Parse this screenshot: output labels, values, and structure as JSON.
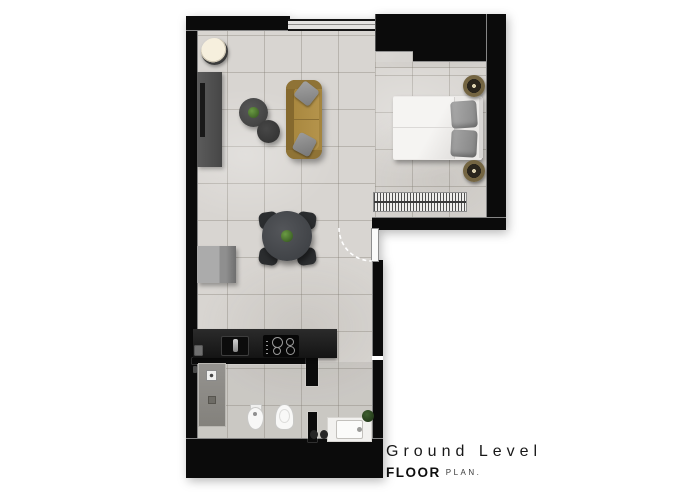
{
  "title": {
    "line1": "Ground Level",
    "line2_bold": "FLOOR",
    "line2_rest": "PLAN."
  },
  "palette": {
    "background": "#ffffff",
    "wall": "#0b0b0b",
    "floor_tile": "#d8d5d1",
    "sofa": "#a5853e",
    "bed": "#eceae8",
    "kitchen_counter": "#1a1a1a",
    "shower": "#8e8c87",
    "plant_accent": "#5a8a3a",
    "nightstand_brass": "#746542",
    "title_text": "#181818"
  },
  "furniture_inventory": [
    "planter",
    "tv-console",
    "tv",
    "coffee-table-large",
    "coffee-table-small",
    "sofa",
    "sofa-pillows",
    "dining-table",
    "dining-chairs",
    "sideboard",
    "double-bed",
    "bed-pillows",
    "nightstands",
    "radiator",
    "entry-door",
    "window",
    "kitchen-counter",
    "kitchen-sink",
    "cooktop",
    "shower",
    "shower-control",
    "bidet",
    "toilet",
    "vanity",
    "vanity-basin",
    "vanity-plant",
    "slippers"
  ]
}
